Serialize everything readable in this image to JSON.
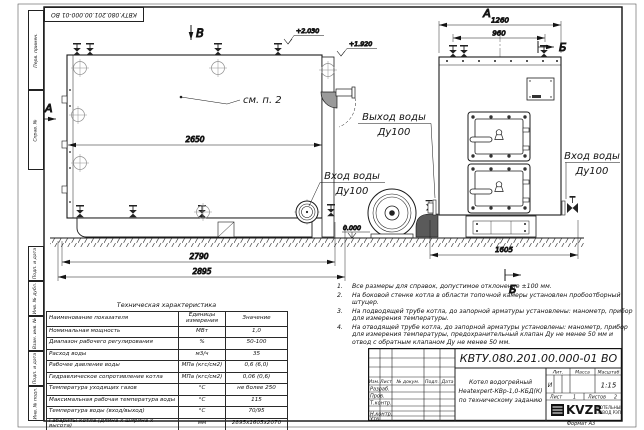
{
  "sheet": {
    "stamp_top": "КВТУ.080.201.00.000-01 ВО",
    "format_note": "Формат А3",
    "margin_top_cells": [
      "Перв. примен.",
      "Справ. №"
    ],
    "margin_bottom_cells": [
      "Подп. и дата",
      "Инв. № дубл.",
      "Взам. инв. №",
      "Подп. и дата",
      "Инв. № подл."
    ]
  },
  "drawing": {
    "side_view": {
      "marker_b": "В",
      "marker_a": "А",
      "see_note": "см. п. 2",
      "dim_inner": "2650",
      "dim_base": "2790",
      "dim_total": "2895",
      "elev_top": "+2.030",
      "elev_flue": "+1.920",
      "elev_zero": "0.000"
    },
    "front_view": {
      "marker_a": "А",
      "marker_b_top": "Б",
      "marker_b_bottom": "Б",
      "dim_total": "1260",
      "dim_valves": "960",
      "dim_width": "1605"
    },
    "labels": {
      "outlet_title": "Выход воды",
      "outlet_dn": "Ду100",
      "inlet_title": "Вход воды",
      "inlet_dn": "Ду100",
      "inlet2_title": "Вход воды",
      "inlet2_dn": "Ду100"
    }
  },
  "notes": [
    {
      "n": "1.",
      "text": "Все размеры для справок, допустимое отклонение ±100 мм."
    },
    {
      "n": "2.",
      "text": "На боковой стенке котла в области топочной камеры установлен пробоотборный штуцер."
    },
    {
      "n": "3.",
      "text": "На подводящей трубе котла, до запорной арматуры установлены: манометр, прибор для измерения температуры."
    },
    {
      "n": "4.",
      "text": "На отводящей трубе котла, до запорной арматуры установлены: манометр, прибор для измерения температуры, предохранительный клапан Ду не менее 50 мм и отвод с обратным клапаном Ду не менее 50 мм."
    }
  ],
  "spec_table": {
    "title": "Техническая характеристика",
    "headers": [
      "Наименование показателя",
      "Единицы измерения",
      "Значение"
    ],
    "rows": [
      [
        "Номинальная мощность",
        "МВт",
        "1,0"
      ],
      [
        "Диапазон рабочего регулирования",
        "%",
        "50-100"
      ],
      [
        "Расход воды",
        "м3/ч",
        "35"
      ],
      [
        "Рабочее давление воды",
        "МПа (кгс/см2)",
        "0,6 (6,0)"
      ],
      [
        "Гидравлическое сопротивление котла",
        "МПа (кгс/см2)",
        "0,06 (0,6)"
      ],
      [
        "Температура уходящих газов",
        "°С",
        "не более 250"
      ],
      [
        "Максимальная рабочая температура воды",
        "°С",
        "115"
      ],
      [
        "Температура воды (вход/выход)",
        "°С",
        "70/95"
      ],
      [
        "Габариты котла (длина х ширина х высота)",
        "мм",
        "2895х1605х2070"
      ]
    ]
  },
  "title_block": {
    "designation": "КВТУ.080.201.00.000-01 ВО",
    "product_line1": "Котел водогрейный",
    "product_line2": "Heatexpert-КВр-1,0-КБД(К)",
    "product_line3": "по техническому заданию",
    "col_izm": "Изм.",
    "col_list": "Лист",
    "col_doc": "№ докум.",
    "col_sign": "Подп.",
    "col_date": "Дата",
    "row_razrab": "Разраб.",
    "row_prov": "Пров.",
    "row_tkontr": "Т.контр.",
    "row_nkontr": "Н.контр.",
    "row_utv": "Утв.",
    "lit_label": "Лит.",
    "mass_label": "Масса",
    "scale_label": "Масштаб",
    "lit_value": "И",
    "scale_value": "1:15",
    "sheet_label": "Лист",
    "sheet_num": "1",
    "sheets_label": "Листов",
    "sheets_num": "2",
    "logo_text": "KVZR",
    "company_line1": "КОТЕЛЬНЫЙ",
    "company_line2": "ЗАВОД РЭП"
  }
}
